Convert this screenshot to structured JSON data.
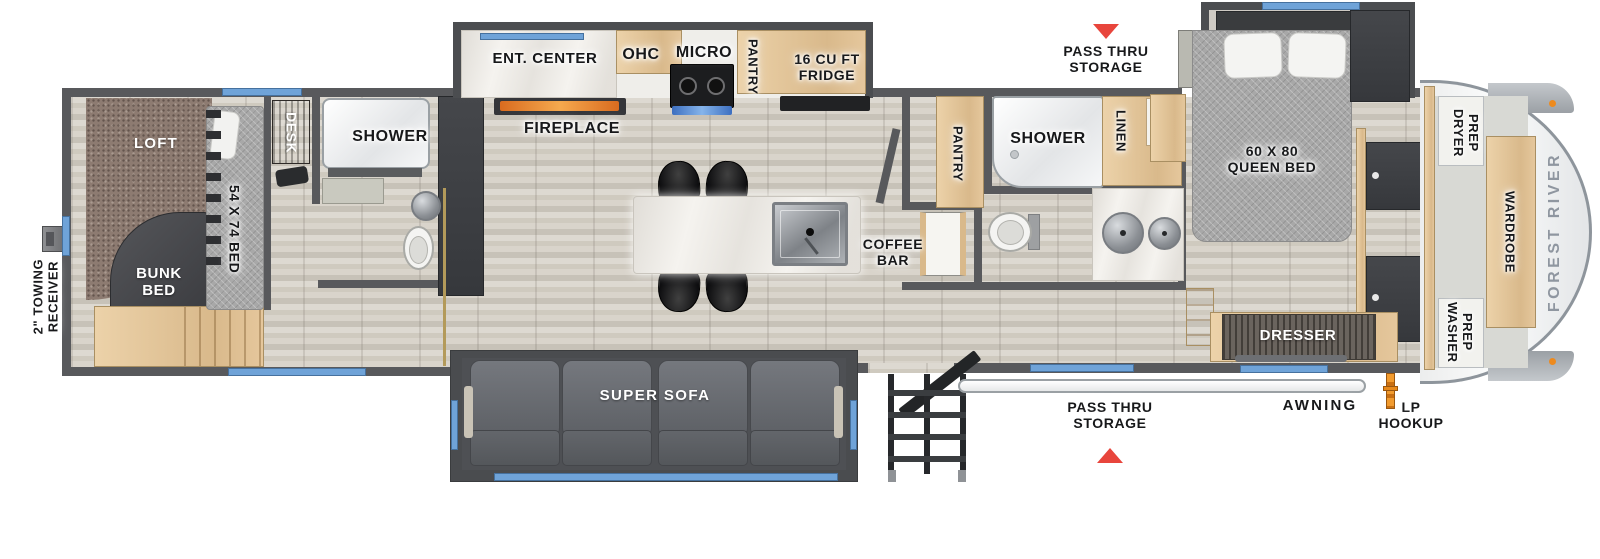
{
  "plan": {
    "brand_label": "FOREST RIVER",
    "colors": {
      "window_blue": "#6fa3d8",
      "marker_red": "#e8453c",
      "lp_orange": "#ed8a1e"
    },
    "exterior": {
      "towing": "2\" TOWING RECEIVER",
      "pass_thru_top": "PASS THRU STORAGE",
      "pass_thru_bottom": "PASS THRU STORAGE",
      "awning": "AWNING",
      "lp": "LP HOOKUP"
    },
    "rear": {
      "loft": "LOFT",
      "bunk": "BUNK BED",
      "bed54": "54 X 74 BED",
      "desk": "DESK",
      "shower": "SHOWER"
    },
    "kitchen": {
      "ent": "ENT. CENTER",
      "ohc": "OHC",
      "micro": "MICRO",
      "pantry": "PANTRY",
      "fridge": "16 CU FT FRIDGE",
      "fireplace": "FIREPLACE",
      "coffee": "COFFEE BAR"
    },
    "living": {
      "sofa": "SUPER SOFA"
    },
    "bath": {
      "pantry": "PANTRY",
      "shower": "SHOWER",
      "linen": "LINEN"
    },
    "master": {
      "queen": "60 X 80 QUEEN BED",
      "dresser": "DRESSER",
      "dryer": "DRYER PREP",
      "wardrobe": "WARDROBE",
      "washer": "WASHER PREP"
    }
  }
}
